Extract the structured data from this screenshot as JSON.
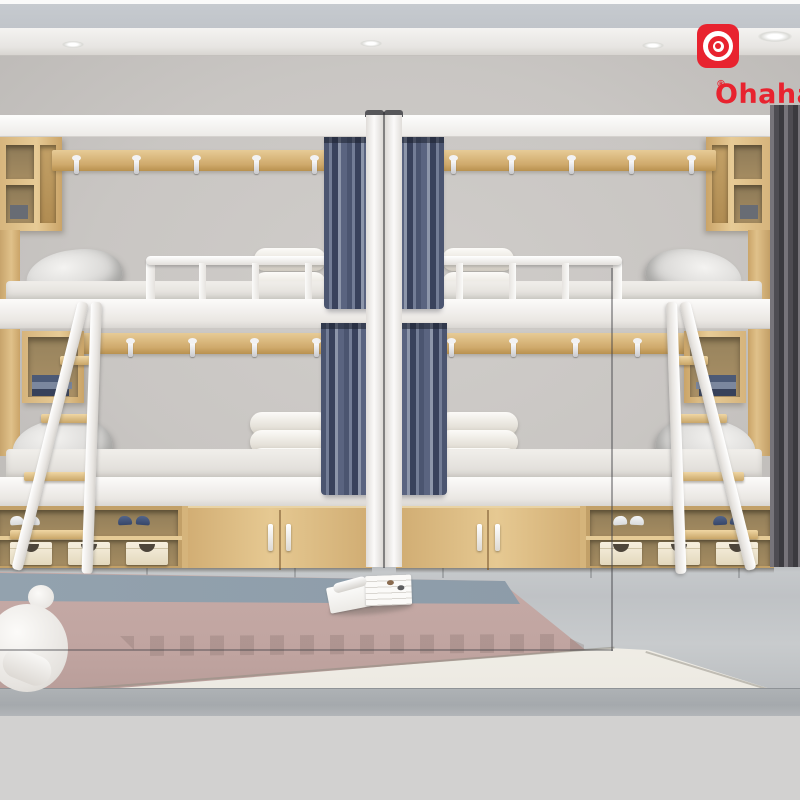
{
  "brand": {
    "name": "Ohaha",
    "registered_mark": "®"
  },
  "logo": {
    "icon": "target-icon"
  },
  "colors": {
    "brand_red": "#e8232f",
    "margin_gray": "#d2d1d0",
    "wall": "#c9c6c3",
    "wood": "#dcbc85",
    "curtain": "#5a6480",
    "frame_white": "#f7f6f4",
    "rug_mauve": "#c0a4a0",
    "rug_blue": "#8fa0ac",
    "floor": "#bfc2c5"
  }
}
